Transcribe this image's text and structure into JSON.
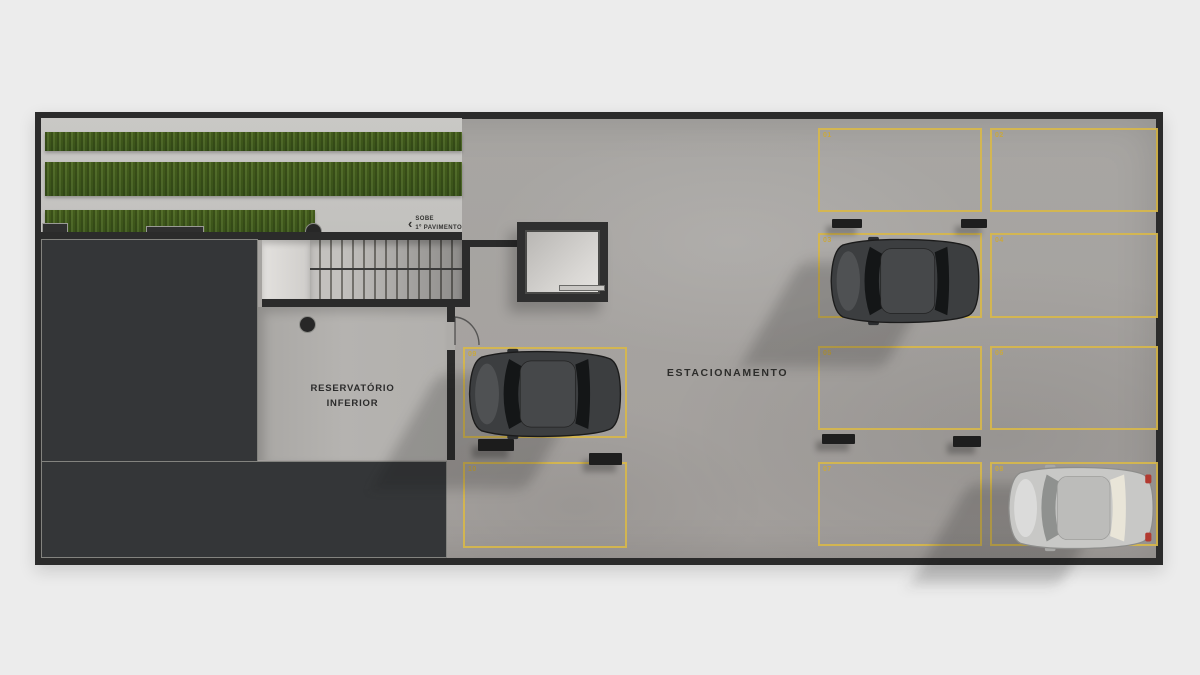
{
  "page": {
    "background": "#ececec"
  },
  "plan": {
    "area_label": "ESTACIONAMENTO",
    "reservoir": {
      "line1": "RESERVATÓRIO",
      "line2": "INFERIOR"
    },
    "stairs": {
      "chevron": "‹",
      "line1": "SOBE",
      "line2": "1º PAVIMENTO"
    },
    "colors": {
      "wall": "#2b2b2b",
      "floor": "#a8a6a3",
      "grass": "#46601f",
      "path": "#c6c5c2",
      "dark_room": "#343638",
      "reservoir_floor": "#b1afac",
      "parking_line": "#d7b74b",
      "space_number": "#c9a83e"
    },
    "spaces": [
      {
        "number": "01",
        "occupied": false
      },
      {
        "number": "02",
        "occupied": false
      },
      {
        "number": "03",
        "occupied": true,
        "vehicle": "dark-suv"
      },
      {
        "number": "04",
        "occupied": false
      },
      {
        "number": "05",
        "occupied": false
      },
      {
        "number": "06",
        "occupied": false
      },
      {
        "number": "07",
        "occupied": false
      },
      {
        "number": "08",
        "occupied": true,
        "vehicle": "silver-sedan"
      },
      {
        "number": "09",
        "occupied": true,
        "vehicle": "dark-suv"
      },
      {
        "number": "10",
        "occupied": false
      }
    ]
  }
}
